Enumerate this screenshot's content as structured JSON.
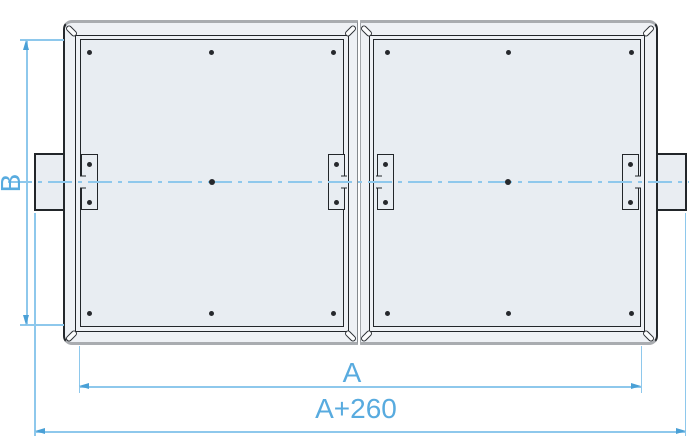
{
  "drawing": {
    "description": "Top view technical drawing of a twin-section fan casing with access panels, corner slots, latches and duct connection flanges",
    "dimension_labels": {
      "height": "B",
      "panel_span": "A",
      "overall_length": "A+260"
    },
    "colors": {
      "dimension_text": "#58abdf",
      "dimension_line": "#8ec8ec",
      "arrow": "#4aa0d6",
      "centerline": "#8ec8ec",
      "outline_dark": "#22262a",
      "edge_gray": "#a9acb0",
      "panel_fill": "#e8edf2",
      "frame_fill": "#eef1f5",
      "background": "#ffffff"
    }
  }
}
